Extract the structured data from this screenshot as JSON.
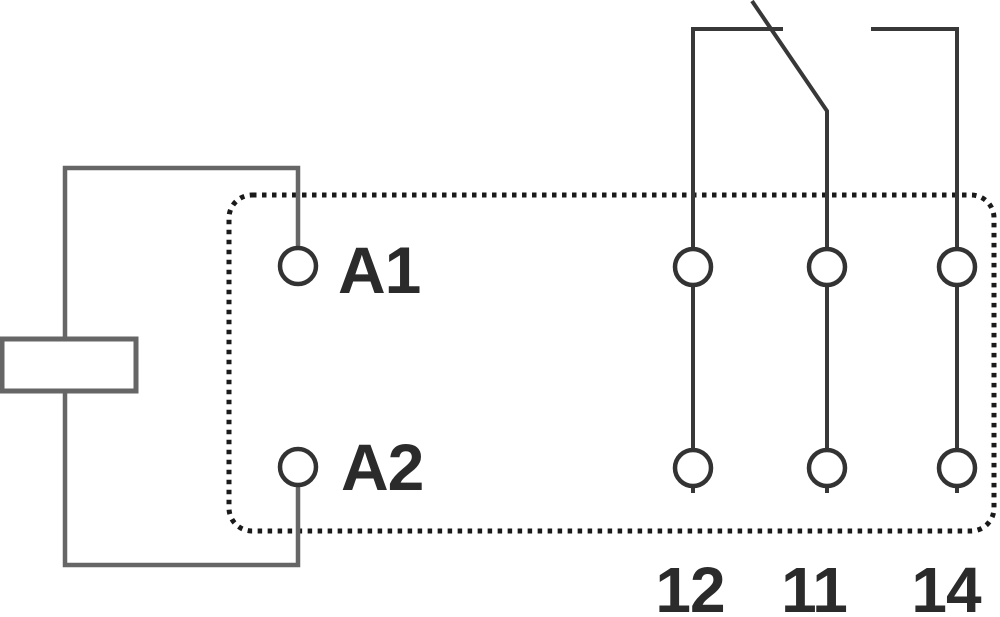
{
  "diagram": {
    "kind": "relay-pin-wiring-schematic",
    "coil_terminals": [
      "A1",
      "A2"
    ],
    "contact_terminals": [
      "12",
      "11",
      "14"
    ],
    "contact_type": "changeover (blade resting toward 12, open toward 14)"
  },
  "labels": {
    "a1": "A1",
    "a2": "A2",
    "c12": "12",
    "c11": "11",
    "c14": "14"
  },
  "colors": {
    "bg": "#ffffff",
    "wire": "#666666",
    "contact": "#383838",
    "outline": "#1a1a1a",
    "terminal": "#333333",
    "text": "#2b2b2b"
  }
}
